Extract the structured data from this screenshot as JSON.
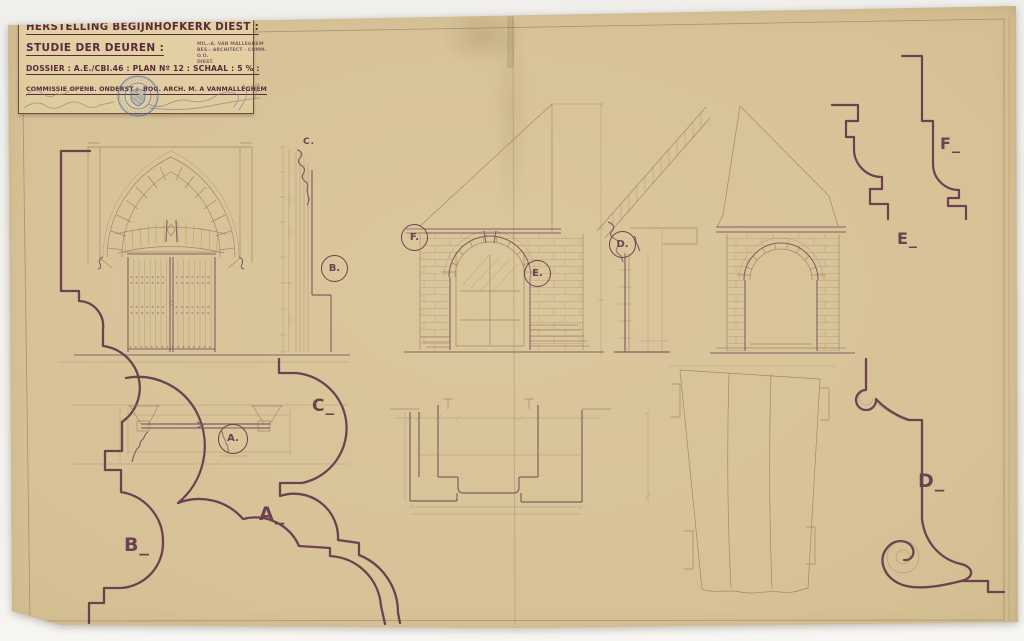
{
  "palette": {
    "background": "#f1f0ed",
    "paper": "#d7c297",
    "ink_bold": "#6d4150",
    "ink_fine": "#97795f",
    "title_ink": "#5a2a3e",
    "stamp_blue": "#4a6cb0",
    "pencil_gray": "#8b8274"
  },
  "title_block": {
    "line1": "HERSTELLING BEGIJNHOFKERK DIEST :",
    "line2": "STUDIE DER DEUREN :",
    "line3": "DOSSIER : A.E./CBI.46 : PLAN Nº 12 : SCHAAL : 5 % :",
    "line4_left": "COMMISSIE OPENB. ONDERST :",
    "line4_right": "BOG. ARCH. M. A VANMALLEGHEM",
    "office_stamp": {
      "line1": "MIL.-A. VAN MALLEGHEM",
      "line2": "BES.- ARCHITECT - COMM. O.O.",
      "line3": "DIEST."
    }
  },
  "annotations": {
    "section_c": "C.",
    "circle_b": "B.",
    "circle_f": "F.",
    "circle_e": "E.",
    "circle_d": "D.",
    "circle_a": "A.",
    "profile_f": "F_",
    "profile_e": "E_",
    "profile_c": "C_",
    "profile_a": "A_",
    "profile_b": "B_",
    "profile_d": "D_"
  }
}
